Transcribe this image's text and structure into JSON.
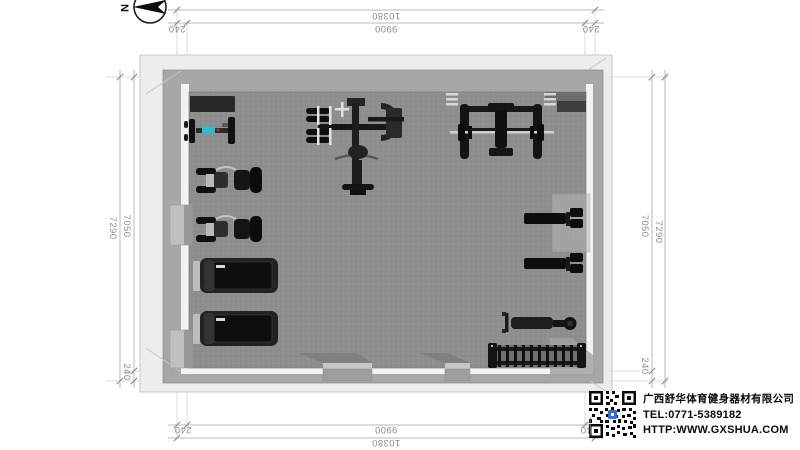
{
  "compass": {
    "north_label": "N"
  },
  "dimensions": {
    "top": {
      "overall": "10380",
      "inner": "9900",
      "left_wall": "240",
      "right_wall": "240"
    },
    "bottom": {
      "overall": "10380",
      "inner": "9900",
      "left_wall": "240",
      "right_wall": "240"
    },
    "left": {
      "overall": "7290",
      "inner": "7050",
      "bottom_wall": "240"
    },
    "right": {
      "overall": "7290",
      "inner": "7050",
      "bottom_wall": "240"
    }
  },
  "company": {
    "name": "广西舒华体育健身器材有限公司",
    "tel": "TEL:0771-5389182",
    "url": "HTTP:WWW.GXSHUA.COM"
  },
  "plan": {
    "room": {
      "floor_color": "#8e8e8e",
      "wall_color": "#a7a7a7",
      "slab_color": "#ededed"
    },
    "equipment": [
      "floor-mat",
      "pec-machine",
      "multi-station-trainer",
      "squat-rack-with-barbell",
      "exercise-bike",
      "exercise-bike",
      "treadmill",
      "treadmill",
      "sit-up-bench",
      "sit-up-bench",
      "rowing-machine",
      "dumbbell-rack"
    ],
    "accent_color": "#3ab6c8",
    "dim_text_color": "#8c8c8c"
  }
}
